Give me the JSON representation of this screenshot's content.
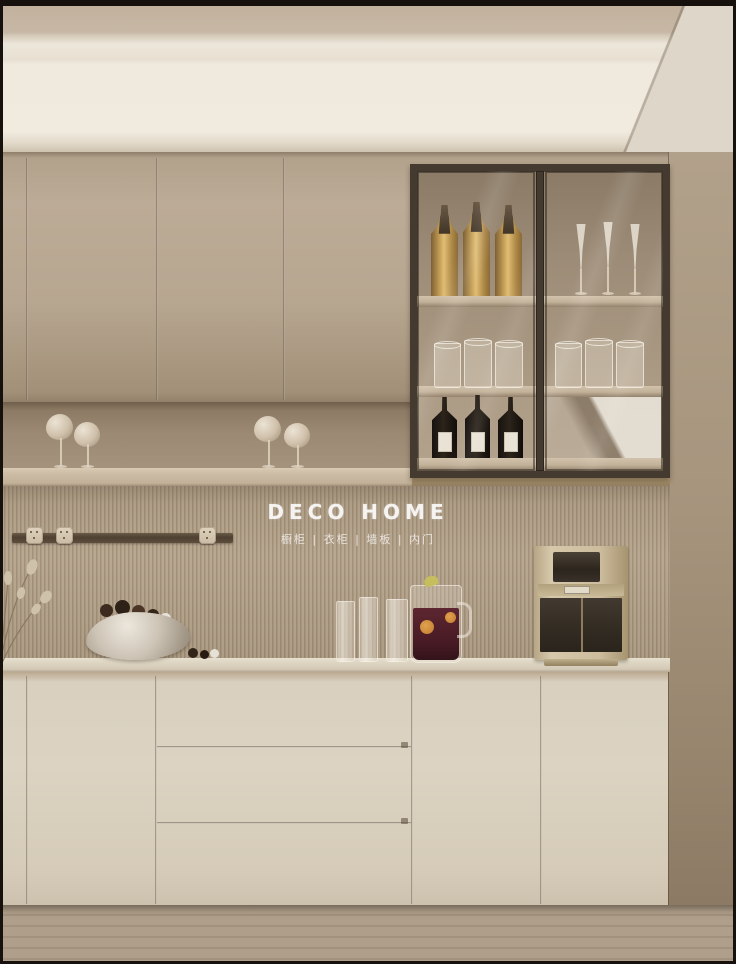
{
  "watermark": {
    "brand": "DECO HOME",
    "tagline": "橱柜 | 衣柜 | 墙板 | 内门"
  },
  "scene": {
    "type": "interior-photograph",
    "setting": "minimalist beige kitchen sideboard wall with fluted slat backsplash, glass display hutch and wood floor",
    "palette": {
      "upper_cabinet_beige": "#b7a690",
      "base_cabinet_cream": "#dcd3c2",
      "slat_wall": "#ab9a82",
      "ceiling_white": "#efe9de",
      "glass_frame_bronze": "#443a2f",
      "countertop": "#ddd4c2",
      "floor_wood": "#a4957f",
      "wine_bottle": "#1f1913",
      "amber_bottle": "#caa45a",
      "dispenser_gold": "#cdbd9e"
    },
    "inventory": {
      "glass_cabinet": {
        "doors": 2,
        "amber_bottles_top_left": 3,
        "champagne_flutes_top_right": 3,
        "tumblers_middle_left": 3,
        "tumblers_middle_right": 3,
        "wine_bottles_bottom_left": 3
      },
      "niche_cotton_glasses": 4,
      "power_track_sockets": 3,
      "counter_items": [
        "dried-plant",
        "rock-bowl-with-chocolates",
        "three-tall-glasses",
        "sangria-pitcher",
        "water-dispenser"
      ],
      "base_drawers": 3
    }
  }
}
